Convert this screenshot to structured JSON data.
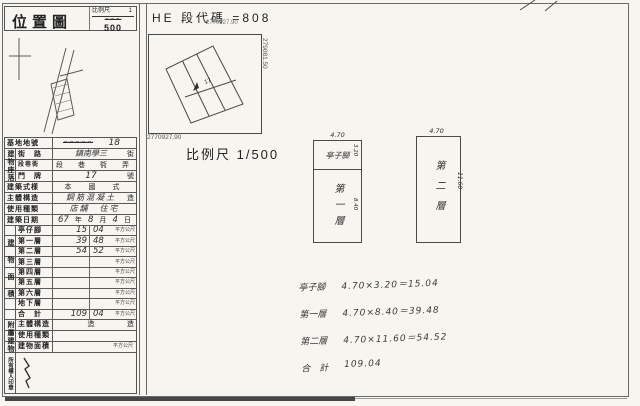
{
  "paper": {
    "title": "位置圖",
    "scale": {
      "label": "比例尺",
      "numerator": "1",
      "crossed": "〜〜〜",
      "denominator": "500"
    }
  },
  "map": {
    "code_line": "HE 段代碼 =808",
    "coord_small_top": "2770927.90",
    "coord_bottom": "2770927.90",
    "coord_right": "279081.50",
    "parcel_number": "17",
    "scale_text": "比例尺 1/500"
  },
  "form": {
    "site_lot": {
      "label": "基地地號",
      "crossed": "〜〜〜〜〜",
      "value": "18"
    },
    "location": {
      "group": "建物座落",
      "street": {
        "label": "街　路",
        "value": "鎮南學三",
        "suffix": "街"
      },
      "section": {
        "label": "段巷衖",
        "units": "段　巷　衖　弄"
      },
      "door": {
        "label": "門　牌",
        "value": "17",
        "suffix": "號"
      }
    },
    "style": {
      "label": "建築式樣",
      "value": "本　國　式"
    },
    "structure": {
      "label": "主體構造",
      "value": "鋼筋混凝土",
      "suffix": "造"
    },
    "usage": {
      "label": "使用種類",
      "value": "店舖　住宅"
    },
    "date": {
      "label": "建築日期",
      "year": "67",
      "year_unit": "年",
      "month": "8",
      "month_unit": "月",
      "day": "4",
      "day_unit": "日"
    },
    "area": {
      "group": "建物面積",
      "unit": "平方公尺",
      "rows": [
        {
          "label": "亭仔腳",
          "int": "15",
          "dec": "04"
        },
        {
          "label": "第一層",
          "int": "39",
          "dec": "48"
        },
        {
          "label": "第二層",
          "int": "54",
          "dec": "52"
        },
        {
          "label": "第三層",
          "int": "",
          "dec": ""
        },
        {
          "label": "第四層",
          "int": "",
          "dec": ""
        },
        {
          "label": "第五層",
          "int": "",
          "dec": ""
        },
        {
          "label": "第六層",
          "int": "",
          "dec": ""
        },
        {
          "label": "地下層",
          "int": "",
          "dec": ""
        },
        {
          "label": "合　計",
          "int": "109",
          "dec": "04"
        }
      ]
    },
    "annex": {
      "group": "附屬建物",
      "rows": [
        {
          "label": "主體構造",
          "mid": "造",
          "right": "造"
        },
        {
          "label": "使用種類",
          "mid": "",
          "right": ""
        },
        {
          "label": "建物面積",
          "mid": "",
          "right": "平方公尺"
        }
      ]
    },
    "seal": {
      "label": "所有權人印章"
    }
  },
  "plans": [
    {
      "name": "第一層",
      "width_dim": "4.70",
      "top_label": "亭子腳",
      "top_height": "3.20",
      "height_dim": "8.40"
    },
    {
      "name": "第二層",
      "width_dim": "4.70",
      "height_dim": "11.60"
    }
  ],
  "calculations": [
    {
      "label": "亭子腳",
      "formula": "4.70×3.20＝15.04"
    },
    {
      "label": "第一層",
      "formula": "4.70×8.40＝39.48"
    },
    {
      "label": "第二層",
      "formula": "4.70×11.60＝54.52"
    },
    {
      "label": "合　計",
      "formula": "109.04"
    }
  ]
}
